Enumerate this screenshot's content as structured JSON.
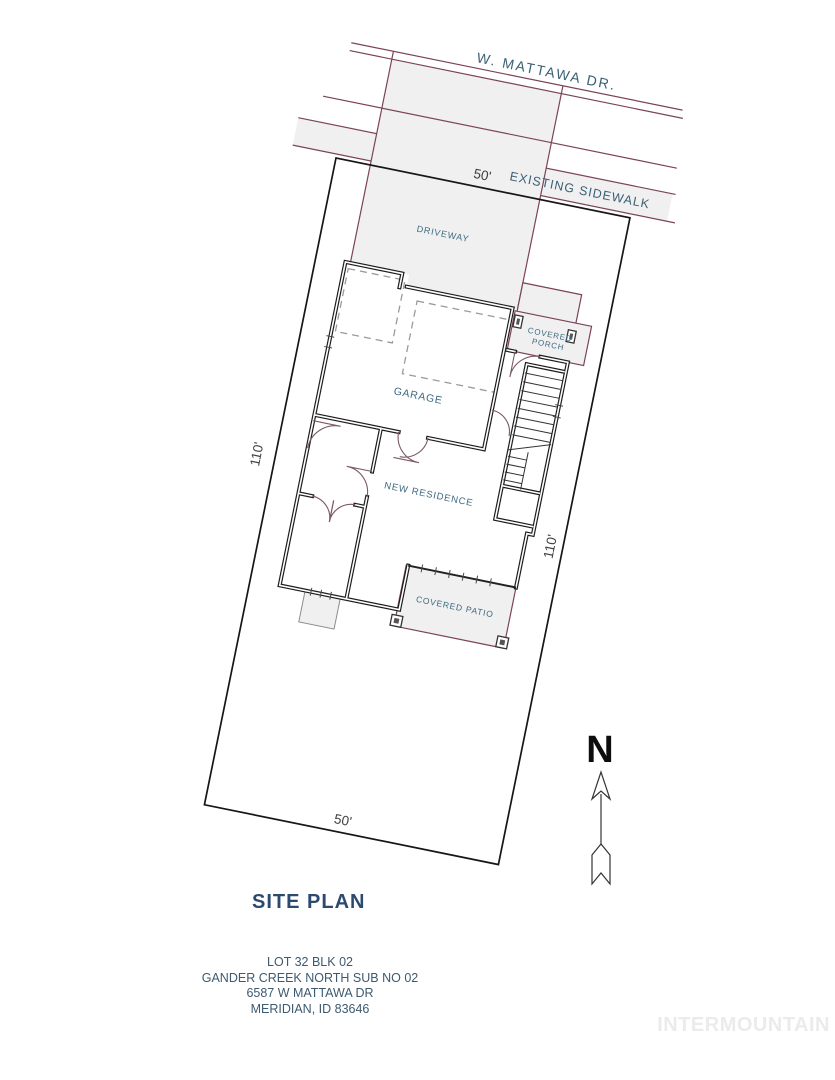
{
  "plan": {
    "street_label": "W. MATTAWA DR.",
    "sidewalk_label": "EXISTING SIDEWALK",
    "driveway_label": "DRIVEWAY",
    "garage_label": "GARAGE",
    "porch_label_line1": "COVERED",
    "porch_label_line2": "PORCH",
    "residence_label": "NEW RESIDENCE",
    "patio_label": "COVERED PATIO",
    "dimensions": {
      "front": "50'",
      "rear": "50'",
      "left_side": "110'",
      "right_side": "110'"
    }
  },
  "north_arrow": {
    "label": "N"
  },
  "footer": {
    "title": "SITE PLAN",
    "address_lines": [
      "LOT 32 BLK 02",
      "GANDER CREEK NORTH SUB NO 02",
      "6587 W MATTAWA DR",
      "MERIDIAN, ID 83646"
    ],
    "watermark": "INTERMOUNTAIN"
  },
  "colors": {
    "background": "#ffffff",
    "lot_boundary": "#161616",
    "road_line_maroon": "#7b4357",
    "paved_fill_gray": "#f1f0f1",
    "wall_black": "#1d1d1d",
    "plan_label_blue": "#3e6a81",
    "road_label_blue": "#3a6075",
    "dimension_gray": "#3f3f3f",
    "title_blue": "#2c4a6e",
    "address_blue": "#3c5a70",
    "watermark_gray": "#ebebeb"
  }
}
